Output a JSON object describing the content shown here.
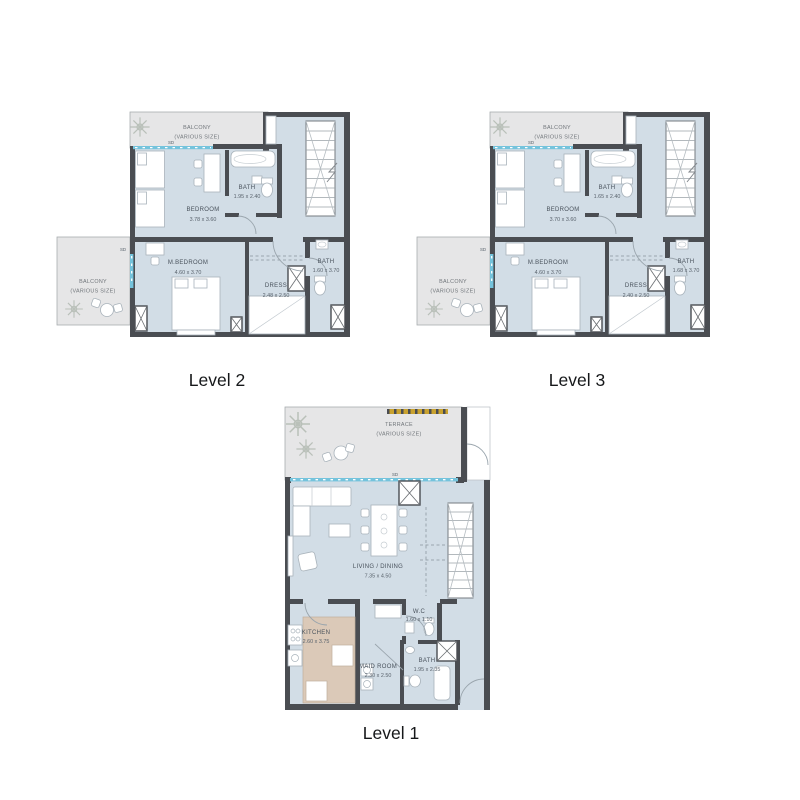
{
  "colors": {
    "floor": "#d2dde6",
    "balcony": "#e6e6e7",
    "wall": "#4a4d52",
    "window_accent": "#74c3dc",
    "kitchen_counter": "#dbc9b8",
    "terrace_strip_gold": "#c9a22f",
    "title_text": "#16181a"
  },
  "plans": {
    "level2": {
      "title": "Level 2",
      "balcony_top": {
        "label": "BALCONY",
        "sublabel": "(VARIOUS SIZE)"
      },
      "sd_top": "SD",
      "bedroom": {
        "label": "BEDROOM",
        "dim": "3.78 x 3.60"
      },
      "bath_upper": {
        "label": "BATH",
        "dim": "1.95 x 2.40"
      },
      "balcony_left": {
        "label": "BALCONY",
        "sublabel": "(VARIOUS SIZE)"
      },
      "sd_left": "SD",
      "master": {
        "label": "M.BEDROOM",
        "dim": "4.60 x 3.70"
      },
      "dress": {
        "label": "DRESS",
        "dim": "2.48 x 2.50"
      },
      "bath_lower": {
        "label": "BATH",
        "dim": "1.60 x 3.70"
      }
    },
    "level3": {
      "title": "Level 3",
      "balcony_top": {
        "label": "BALCONY",
        "sublabel": "(VARIOUS SIZE)"
      },
      "sd_top": "SD",
      "bedroom": {
        "label": "BEDROOM",
        "dim": "3.70 x 3.60"
      },
      "bath_upper": {
        "label": "BATH",
        "dim": "1.65 x 2.40"
      },
      "balcony_left": {
        "label": "BALCONY",
        "sublabel": "(VARIOUS SIZE)"
      },
      "sd_left": "SD",
      "master": {
        "label": "M.BEDROOM",
        "dim": "4.60 x 3.70"
      },
      "dress": {
        "label": "DRESS",
        "dim": "2.40 x 2.50"
      },
      "bath_lower": {
        "label": "BATH",
        "dim": "1.68 x 3.70"
      }
    },
    "level1": {
      "title": "Level 1",
      "terrace": {
        "label": "TERRACE",
        "sublabel": "(VARIOUS SIZE)"
      },
      "sd": "SD",
      "living": {
        "label": "LIVING / DINING",
        "dim": "7.35 x 4.50"
      },
      "kitchen": {
        "label": "KITCHEN",
        "dim": "2.60 x 3.75"
      },
      "wc": {
        "label": "W.C",
        "dim": "1.60 x 1.10"
      },
      "maid": {
        "label": "MAID ROOM",
        "dim": "2.30 x 2.50"
      },
      "bath": {
        "label": "BATH",
        "dim": "1.95 x 2.35"
      }
    }
  }
}
